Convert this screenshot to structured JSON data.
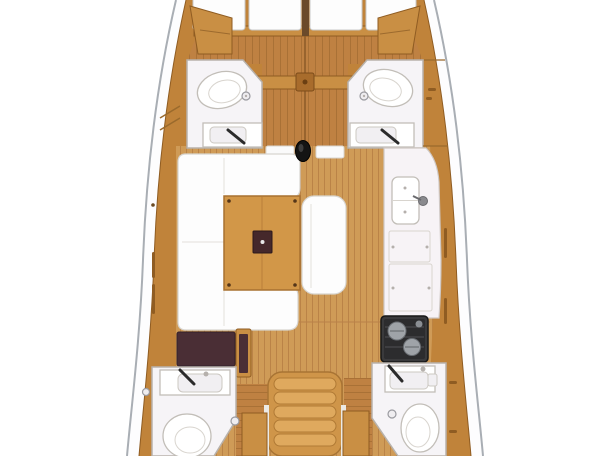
{
  "meta": {
    "type": "floor-plan",
    "subject": "sailing-yacht interior layout, top-down view, hull cropped at bow and stern"
  },
  "colors": {
    "hull_band": "#fdfdfe",
    "hull_line": "#a9aeb4",
    "wood_trim": "#c0833a",
    "wood_box": "#c98f44",
    "wood_edge": "#8f5c22",
    "floor_base": "#cf9b57",
    "floor_stripe": "#ba8347",
    "bow_floor_base": "#bf8142",
    "bow_floor_stripe": "#a97136",
    "table_wood": "#d29748",
    "steps_body": "#cf9549",
    "steps_tread": "#dfa95e",
    "upholstery": "#fdfdfd",
    "upholstery_line": "#d8d5d0",
    "bathroom_floor": "#f6f4f7",
    "fixture_line": "#c2beb8",
    "galley_counter": "#f7f3f6",
    "stove_body": "#3a3a3c",
    "burner": "#9fa3a8",
    "nav_desk": "#4a2e35",
    "table_box": "#45282b",
    "mast_post": "#141414",
    "faucet": "#2b2b2b",
    "berth_seam": "#6b4a2a"
  },
  "areas": [
    {
      "id": "bow-cabin",
      "label": "V-berth cabin (split cushions)"
    },
    {
      "id": "head-forward-port",
      "label": "Forward head port: toilet, drain, sink with faucet"
    },
    {
      "id": "head-forward-starboard",
      "label": "Forward head starboard: toilet, drain, sink with faucet"
    },
    {
      "id": "saloon",
      "label": "Saloon: U-settee port, wood table with dark box, straight bench starboard, mast post"
    },
    {
      "id": "galley",
      "label": "Galley starboard: double sink with faucet, counters, two-burner stove"
    },
    {
      "id": "nav-station",
      "label": "Navigation desk port aft (dark top with seat)"
    },
    {
      "id": "companionway",
      "label": "Companionway steps center aft with side lockers"
    },
    {
      "id": "head-aft-port",
      "label": "Aft head port: sink with faucet, toilet"
    },
    {
      "id": "head-aft-starboard",
      "label": "Aft head starboard: sink with faucet, toilet"
    }
  ],
  "counts": {
    "visible_heads": 4,
    "visible_toilets": 4,
    "visible_sinks": 5,
    "stove_burners": 2
  }
}
